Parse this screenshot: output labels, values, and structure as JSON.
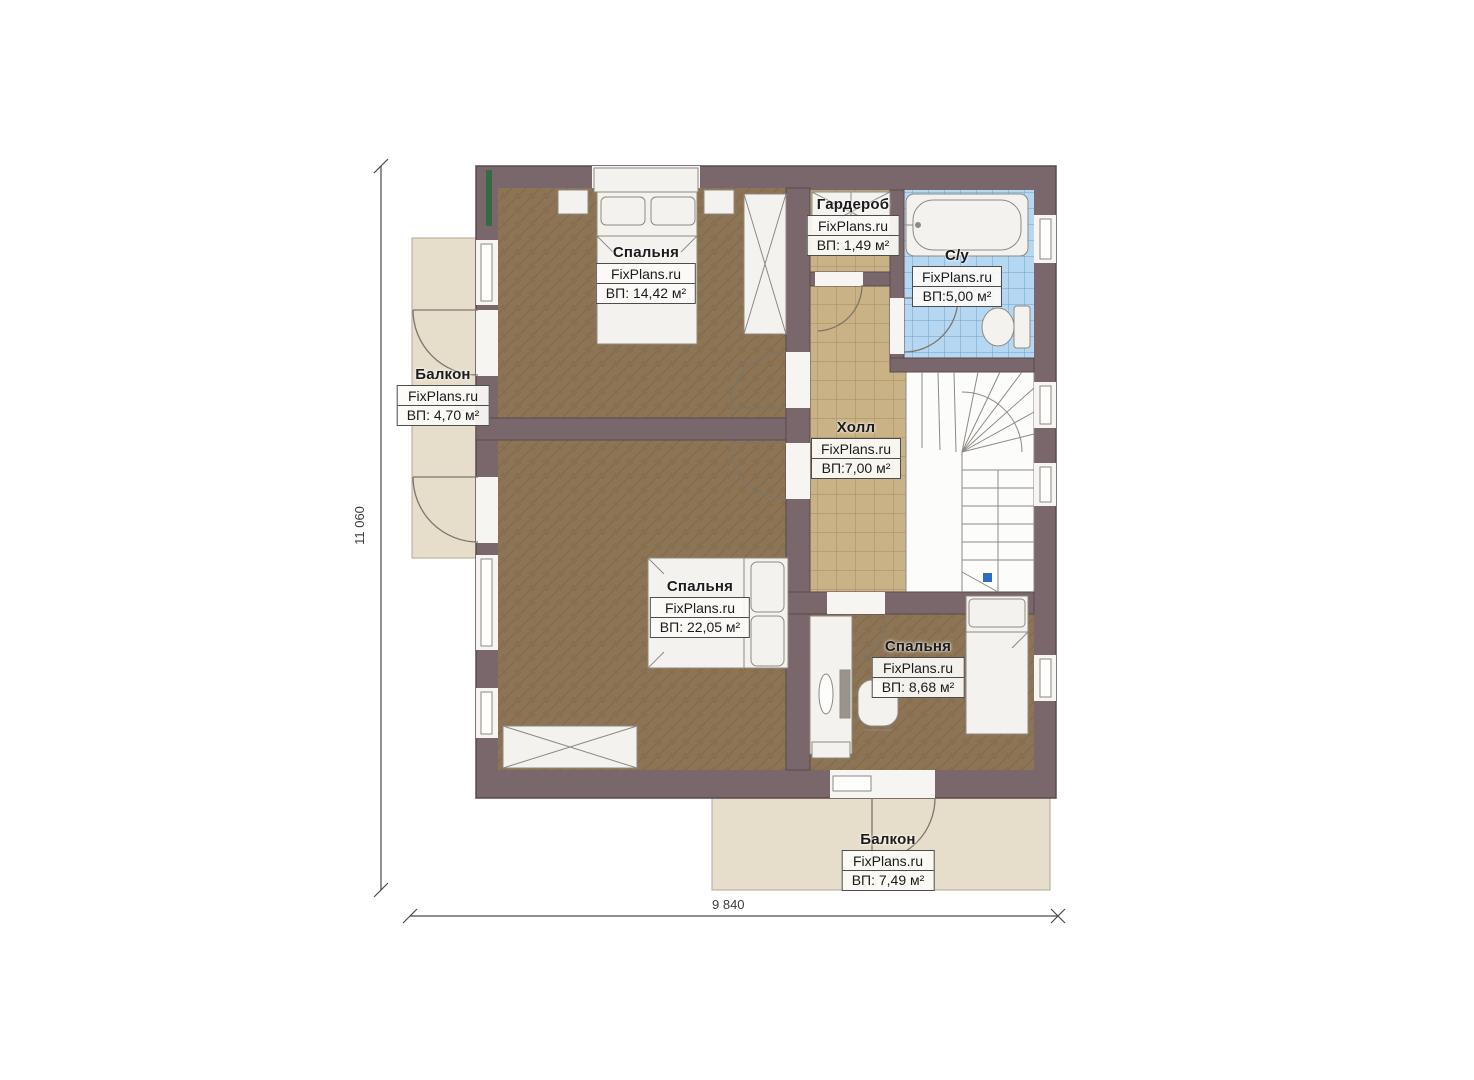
{
  "plan": {
    "title": "second-floor-plan",
    "dimensions": {
      "width_label": "9 840",
      "height_label": "11 060"
    },
    "rooms": [
      {
        "id": "bedroom-top",
        "name": "Спальня",
        "brand": "FixPlans.ru",
        "area": "ВП: 14,42 м²"
      },
      {
        "id": "wardrobe",
        "name": "Гардероб",
        "brand": "FixPlans.ru",
        "area": "ВП: 1,49 м²"
      },
      {
        "id": "bathroom",
        "name": "С/у",
        "brand": "FixPlans.ru",
        "area": "ВП:5,00 м²"
      },
      {
        "id": "balcony-left",
        "name": "Балкон",
        "brand": "FixPlans.ru",
        "area": "ВП: 4,70 м²"
      },
      {
        "id": "hall",
        "name": "Холл",
        "brand": "FixPlans.ru",
        "area": "ВП:7,00 м²"
      },
      {
        "id": "bedroom-master",
        "name": "Спальня",
        "brand": "FixPlans.ru",
        "area": "ВП: 22,05 м²"
      },
      {
        "id": "bedroom-small",
        "name": "Спальня",
        "brand": "FixPlans.ru",
        "area": "ВП: 8,68 м²"
      },
      {
        "id": "balcony-bottom",
        "name": "Балкон",
        "brand": "FixPlans.ru",
        "area": "ВП: 7,49 м²"
      }
    ],
    "colors": {
      "wall": "#7a676b",
      "wall_outline": "#594a4e",
      "floor_wood": "#8c7454",
      "floor_tile_tan": "#c9b285",
      "floor_tile_blue": "#b6d7f1",
      "balcony": "#e6ddca",
      "furniture": "#f3f2ee",
      "stairs_marker": "#2f6bc4",
      "green_accent": "#356b44"
    }
  }
}
